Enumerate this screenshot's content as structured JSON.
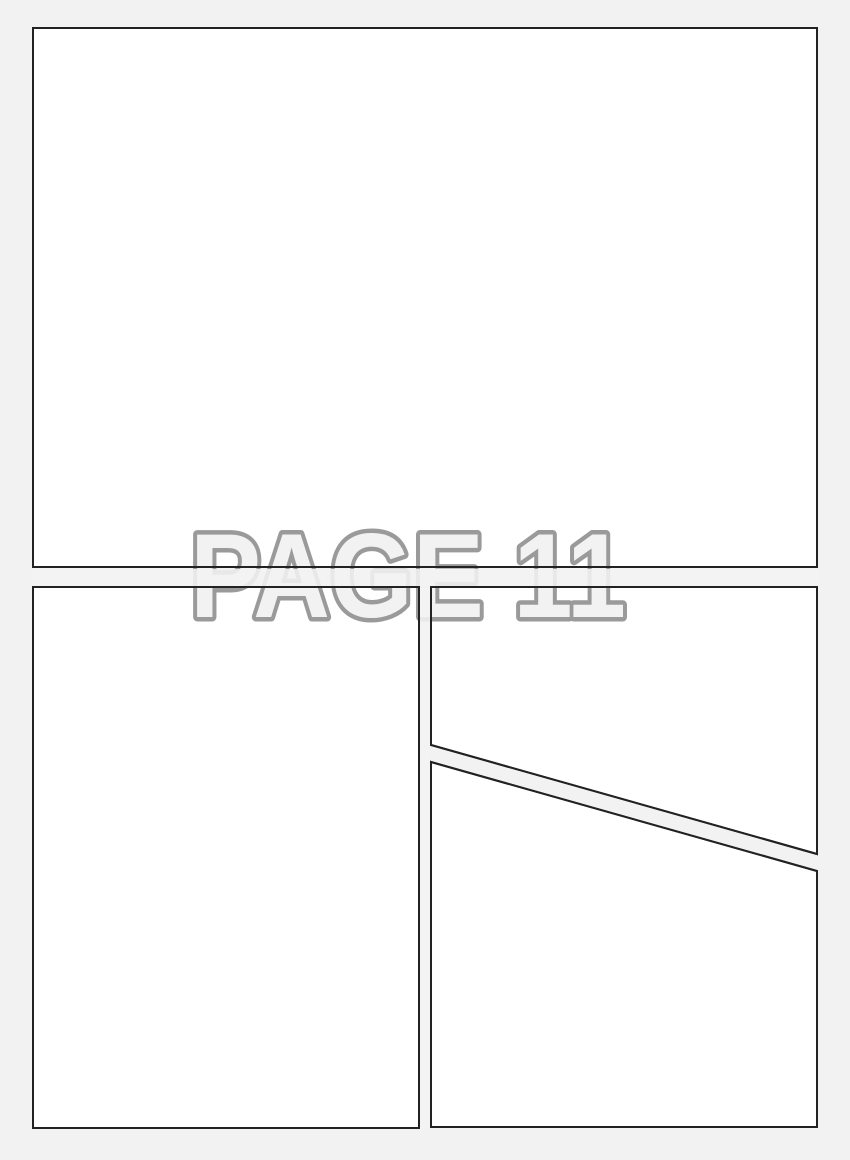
{
  "page": {
    "label": "PAGE 11"
  },
  "theme": {
    "page-bg": "#f2f2f2",
    "panel-fill": "#ffffff",
    "panel-border": "#222222",
    "label-outline": "#9a9a9a",
    "label-fill": "#f2f2f2"
  },
  "panels": [
    {
      "name": "top"
    },
    {
      "name": "bottom-left"
    },
    {
      "name": "bottom-right-upper"
    },
    {
      "name": "bottom-right-lower"
    }
  ]
}
